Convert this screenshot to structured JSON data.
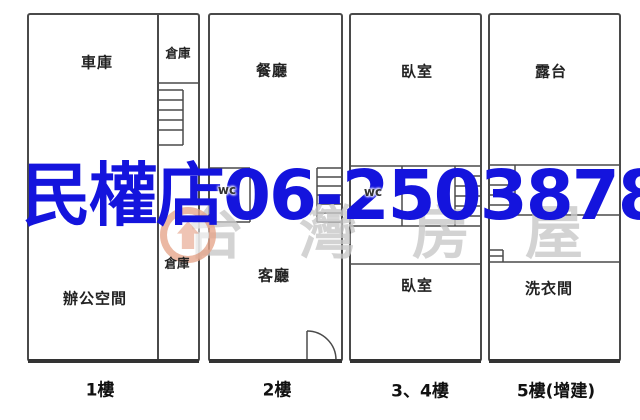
{
  "watermark": {
    "store_phone_text": "民權店06-2503878",
    "brand_text": "台灣房屋",
    "blue_color": "#1414dd",
    "gray_color": "#c9c9c9",
    "logo_color": "#db7d58"
  },
  "line_color": "#4a4a4a",
  "units": [
    {
      "id": "unit-1f",
      "floor_label": "1樓",
      "rooms": {
        "garage": "車庫",
        "storage_top": "倉庫",
        "storage_bottom": "倉庫",
        "office": "辦公空間"
      }
    },
    {
      "id": "unit-2f",
      "floor_label": "2樓",
      "rooms": {
        "dining": "餐廳",
        "wc": "wc",
        "living": "客廳"
      }
    },
    {
      "id": "unit-3-4f",
      "floor_label": "3、4樓",
      "rooms": {
        "bedroom_upper": "臥室",
        "wc": "wc",
        "bedroom_lower": "臥室"
      }
    },
    {
      "id": "unit-5f",
      "floor_label": "5樓(增建)",
      "rooms": {
        "terrace": "露台",
        "laundry": "洗衣間"
      }
    }
  ]
}
